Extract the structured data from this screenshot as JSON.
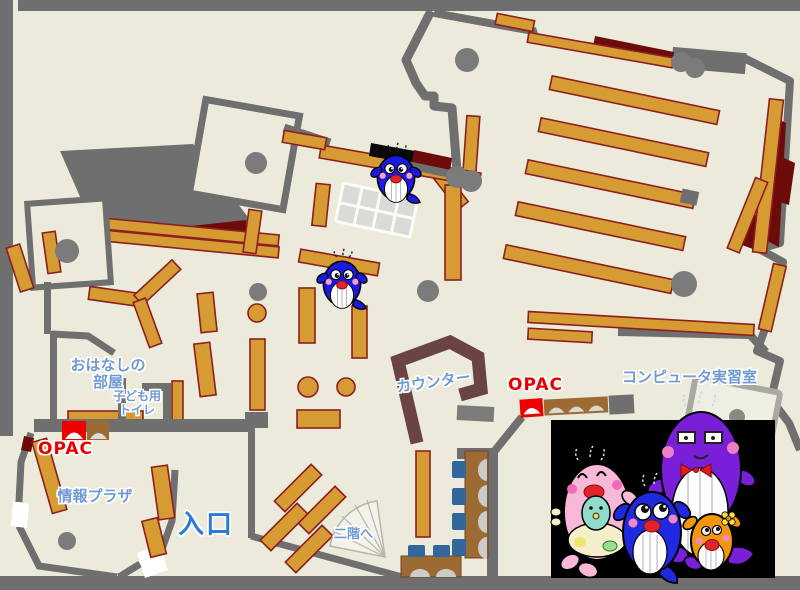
{
  "map": {
    "rooms": {
      "story_room": {
        "name_line1": "おはなしの",
        "name_line2": "部屋"
      },
      "kids_toilet": {
        "name_line1": "子ども用",
        "name_line2": "トイレ"
      },
      "info_plaza": {
        "name": "情報プラザ"
      },
      "entrance": {
        "name": "入口"
      },
      "stairs_up": {
        "name": "二階へ"
      },
      "counter": {
        "name": "カウンター"
      },
      "computer_room": {
        "name": "コンピュータ実習室"
      }
    },
    "terminals": {
      "opac_left": "OPAC",
      "opac_right": "OPAC"
    },
    "colors": {
      "floor": "#ecebdb",
      "wall_gray": "#6f6f6f",
      "shelf_orange": "#d79b33",
      "shelf_border": "#8c1f1f",
      "accent_dark_red": "#6d0a0a",
      "counter_brown": "#6a4343",
      "desk_brown": "#9c6b33",
      "chair_blue": "#33679b",
      "table_gray": "#dadad6",
      "pillar_gray": "#7b7b7b",
      "label_blue": "#6f9bd2",
      "entrance_blue": "#2b7cd9",
      "opac_red": "#e80000",
      "mascot_blue": "#1a1ae0",
      "panel_black": "#000000"
    },
    "mascots": {
      "on_map": [
        "blue-whale-mascot",
        "blue-whale-mascot"
      ],
      "family_panel": [
        "pink-whale-mascot",
        "purple-whale-mascot",
        "blue-whale-mascot",
        "orange-whale-mascot",
        "baby-whale-mascot"
      ]
    }
  }
}
